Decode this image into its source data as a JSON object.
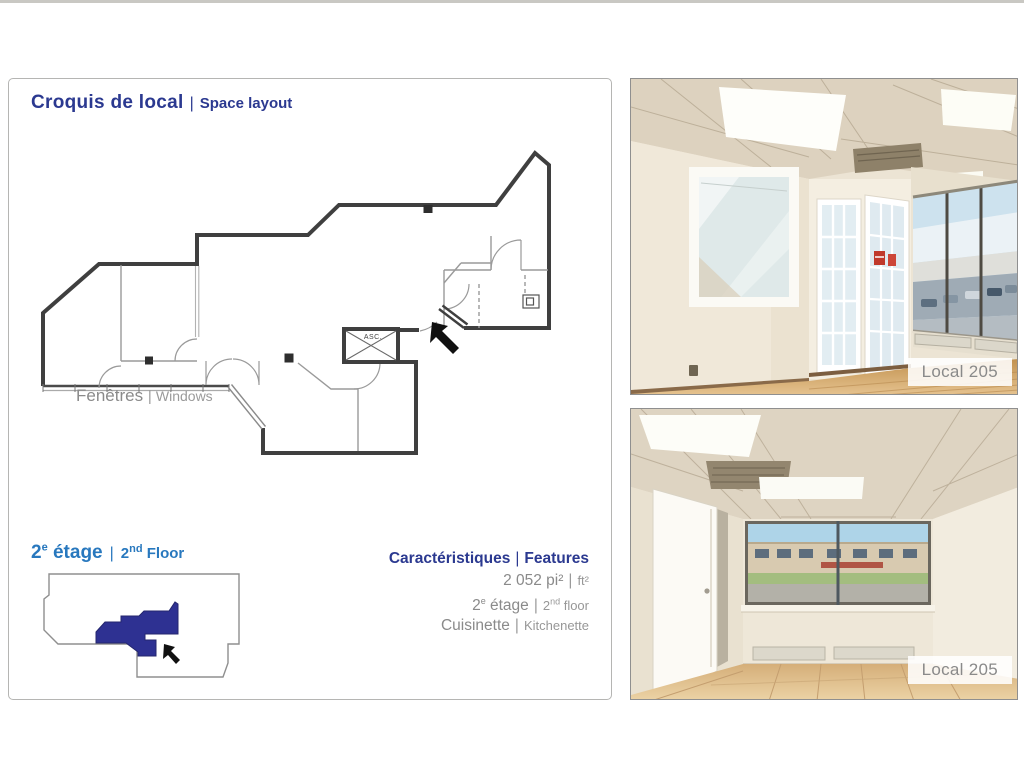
{
  "panel": {
    "title_fr": "Croquis de local",
    "title_sep": "|",
    "title_en": "Space layout"
  },
  "floor_plan": {
    "windows_label_fr": "Fenêtres ",
    "windows_label_sep": "| ",
    "windows_label_en": "Windows",
    "elevator_label": "ASC."
  },
  "mini_map": {
    "floor_num": "2",
    "floor_sup_fr": "e",
    "floor_word_fr": " étage",
    "sep": "|",
    "floor_num_en": "2",
    "floor_sup_en": "nd",
    "floor_word_en": " Floor"
  },
  "features": {
    "heading_fr": "Caractéristiques",
    "heading_sep": "|",
    "heading_en": "Features",
    "area_fr": "2 052 pi²",
    "area_sep": "|",
    "area_en": "ft²",
    "floor_num": "2",
    "floor_sup_fr": "e",
    "floor_word_fr": " étage",
    "floor_sep": "|",
    "floor_num_en": "2",
    "floor_sup_en": "nd",
    "floor_word_en": " floor",
    "kitchen_fr": "Cuisinette",
    "kitchen_sep": "|",
    "kitchen_en": "Kitchenette"
  },
  "photos": {
    "top_label": "Local 205",
    "bottom_label": "Local 205"
  },
  "colors": {
    "accent_navy": "#2B3990",
    "accent_blue": "#2878BE",
    "highlight_navy": "#2E3192",
    "text_gray": "#8A8A8A",
    "wall_dark": "#3F3F3F"
  }
}
